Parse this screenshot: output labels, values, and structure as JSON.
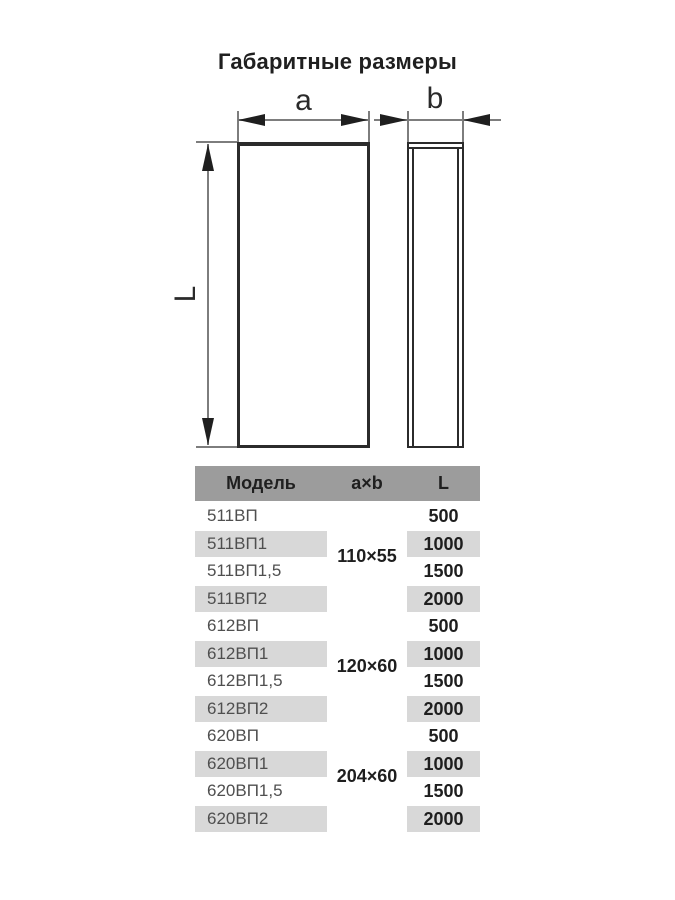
{
  "title": "Габаритные размеры",
  "diagram": {
    "dim_a_label": "a",
    "dim_b_label": "b",
    "dim_l_label": "L"
  },
  "table": {
    "headers": [
      "Модель",
      "a×b",
      "L"
    ],
    "groups": [
      {
        "size": "110×55",
        "rows": [
          {
            "model": "511ВП",
            "length": "500"
          },
          {
            "model": "511ВП1",
            "length": "1000"
          },
          {
            "model": "511ВП1,5",
            "length": "1500"
          },
          {
            "model": "511ВП2",
            "length": "2000"
          }
        ]
      },
      {
        "size": "120×60",
        "rows": [
          {
            "model": "612ВП",
            "length": "500"
          },
          {
            "model": "612ВП1",
            "length": "1000"
          },
          {
            "model": "612ВП1,5",
            "length": "1500"
          },
          {
            "model": "612ВП2",
            "length": "2000"
          }
        ]
      },
      {
        "size": "204×60",
        "rows": [
          {
            "model": "620ВП",
            "length": "500"
          },
          {
            "model": "620ВП1",
            "length": "1000"
          },
          {
            "model": "620ВП1,5",
            "length": "1500"
          },
          {
            "model": "620ВП2",
            "length": "2000"
          }
        ]
      }
    ]
  },
  "colors": {
    "header_bg": "#9c9c9c",
    "stripe_bg": "#d8d8d8",
    "model_text": "#4f4f4f",
    "value_text": "#1e1e1e",
    "line_dark": "#2b2b2b",
    "line_thin": "#7d7d7d"
  }
}
